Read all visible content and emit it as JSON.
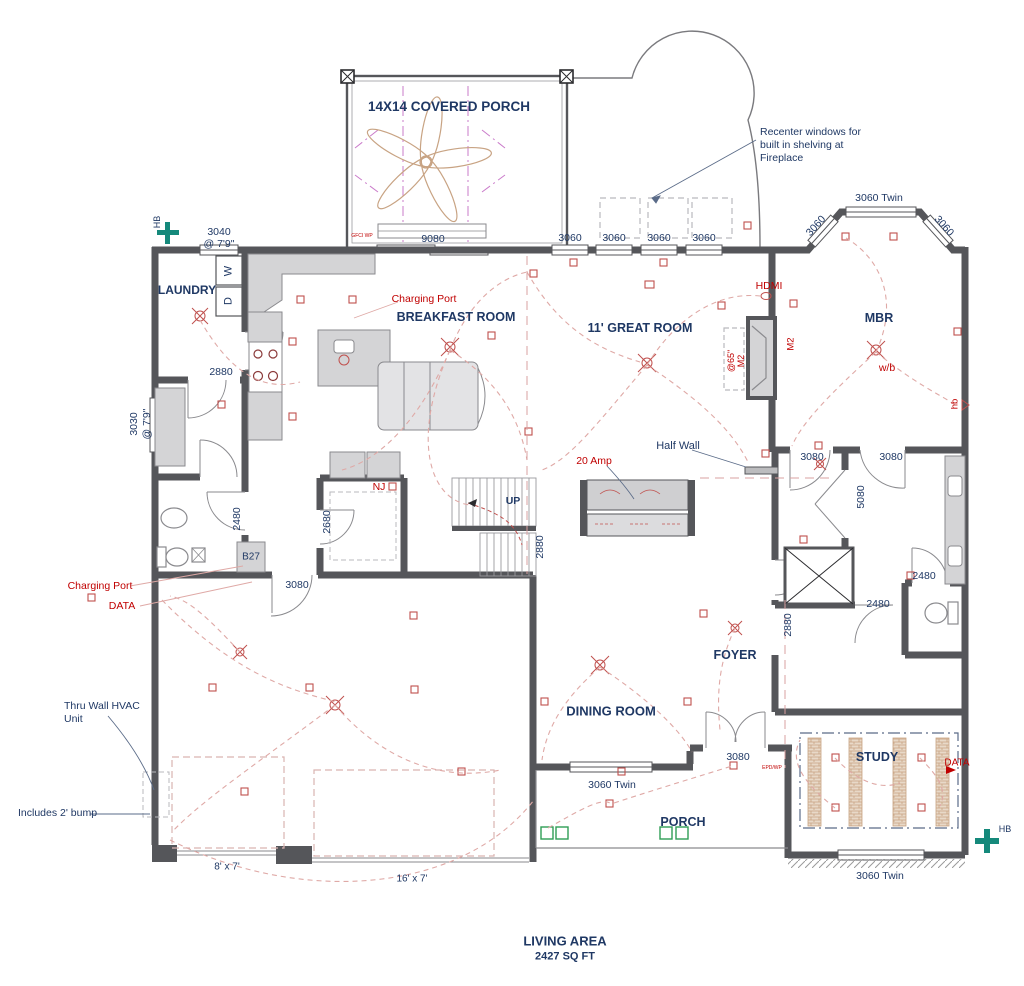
{
  "plan": {
    "living_area_title": "LIVING AREA",
    "living_area_sqft": "2427 SQ FT"
  },
  "rooms": {
    "covered_porch": "14X14 COVERED PORCH",
    "laundry": "LAUNDRY",
    "breakfast": "BREAKFAST ROOM",
    "great_room": "11' GREAT ROOM",
    "mbr": "MBR",
    "foyer": "FOYER",
    "dining": "DINING ROOM",
    "study": "STUDY",
    "porch": "PORCH"
  },
  "fixtures": {
    "washer": "W",
    "dryer": "D",
    "cabinet_b27": "B27"
  },
  "dims": {
    "d3040": "3040",
    "at79": "@ 7'9\"",
    "d3030": "3030",
    "d9080": "9080",
    "d3060": "3060",
    "d3060_twin": "3060 Twin",
    "d2880": "2880",
    "d2480": "2480",
    "d2680": "2680",
    "d3080": "3080",
    "d5080": "5080",
    "s8x7": "8' x 7'",
    "s16x7": "16' x 7'"
  },
  "annotations": {
    "recenter": "Recenter windows for built in shelving at Fireplace",
    "half_wall": "Half Wall",
    "thru_wall": "Thru Wall HVAC Unit",
    "bump": "Includes 2' bump",
    "up": "UP",
    "hb": "HB"
  },
  "electrical": {
    "charging_port": "Charging Port",
    "data": "DATA",
    "hdmi": "HDMI",
    "amp20": "20 Amp",
    "nj": "NJ",
    "m2": "M2",
    "at65": "@65\"",
    "wb": "w/b",
    "hb_small": "hb",
    "gfci": "GFCI WP",
    "epd": "EPD/WP"
  },
  "colors": {
    "navy": "#1f3864",
    "red": "#c00000",
    "wall": "#55565a",
    "teal": "#15897b",
    "green": "#2f9e55",
    "wire": "#dfa9a6",
    "hatch": "#c8a383"
  }
}
